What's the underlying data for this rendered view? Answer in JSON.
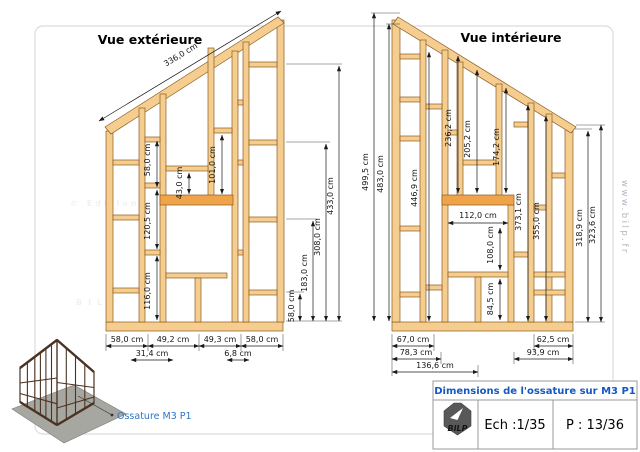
{
  "sheet": {
    "watermark_line1": "© Editions",
    "watermark_line2": "BILP",
    "site": "www.bilp.fr"
  },
  "exterior": {
    "title": "Vue extérieure",
    "slope": "336,0 cm",
    "inner": {
      "d58": "58,0 cm",
      "d120": "120,5 cm",
      "d116": "116,0 cm",
      "d43": "43,0 cm",
      "d101": "101,0 cm"
    },
    "right": {
      "d58": "58,0 cm",
      "d183": "183,0 cm",
      "d308": "308,0 cm",
      "d433": "433,0 cm"
    },
    "bottom": {
      "b1": "58,0 cm",
      "b2": "49,2 cm",
      "b3": "49,3 cm",
      "b4": "58,0 cm",
      "s1": "31,4 cm",
      "s2": "6,8 cm"
    }
  },
  "interior": {
    "title": "Vue intérieure",
    "left": {
      "d499": "499,5 cm",
      "d483": "483,0 cm"
    },
    "inner": {
      "d446": "446,9 cm",
      "d236": "236,2 cm",
      "d205": "205,2 cm",
      "d174": "174,2 cm",
      "d112": "112,0 cm",
      "d108": "108,0 cm",
      "d84": "84,5 cm",
      "d373": "373,1 cm",
      "d355": "355,0 cm"
    },
    "right": {
      "d318": "318,9 cm",
      "d323": "323,6 cm"
    },
    "bottom": {
      "b1": "67,0 cm",
      "b2": "62,5 cm",
      "s1": "78,3 cm",
      "s2": "93,9 cm",
      "t1": "136,6 cm"
    }
  },
  "inset": {
    "label": "Ossature M3 P1"
  },
  "title_block": {
    "title": "Dimensions de l'ossature sur M3 P1",
    "logo_text": "BILP",
    "scale_label": "Ech :1/35",
    "page_label": "P : 13/36"
  },
  "colors": {
    "wood": "#F5CE8F",
    "header_wood": "#EFA449",
    "accent_blue": "#1557c4",
    "label_blue": "#2e74c8"
  }
}
